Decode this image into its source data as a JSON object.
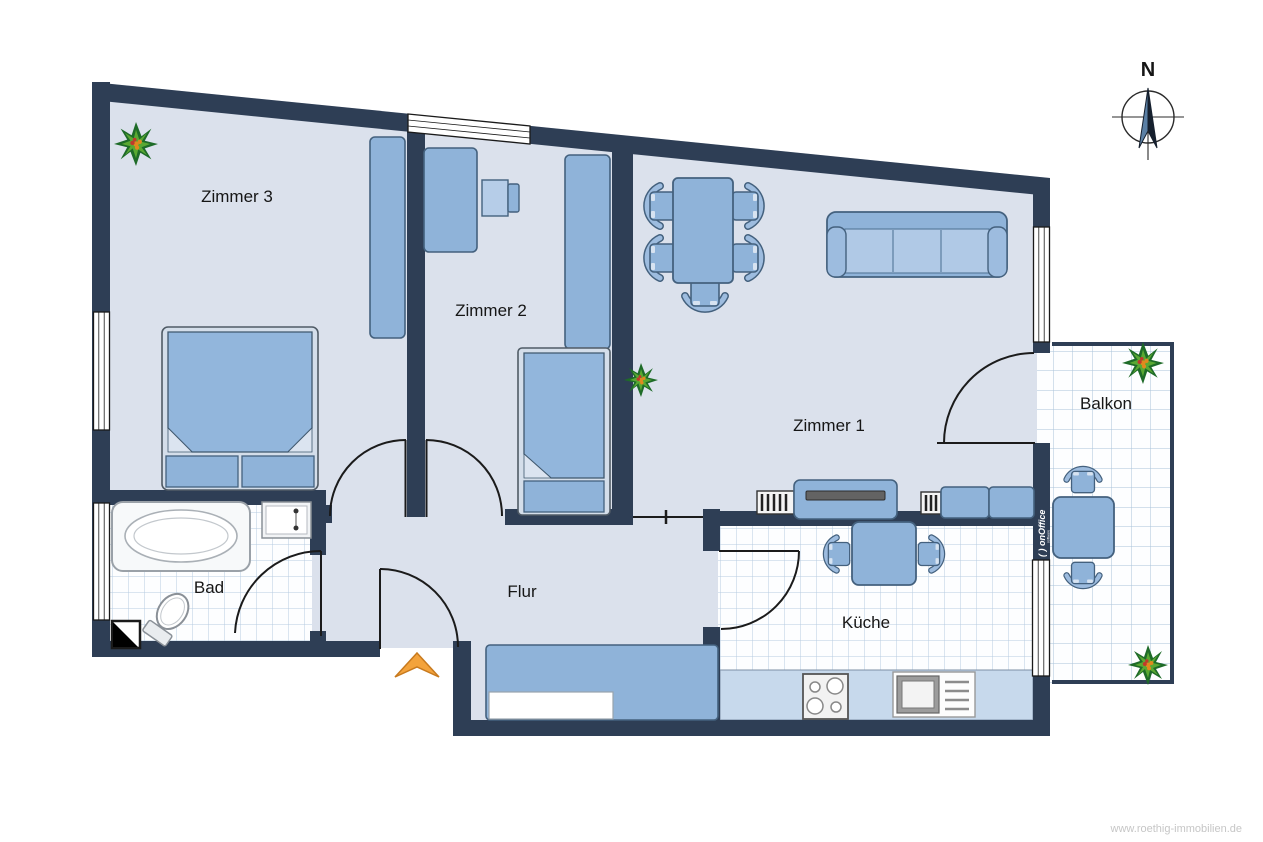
{
  "meta": {
    "watermark": "www.roethig-immobilien.de"
  },
  "compass": {
    "label": "N"
  },
  "branding": {
    "logo_primary": "( ) onOffice",
    "logo_secondary": "software"
  },
  "rooms": {
    "zimmer3": {
      "label": "Zimmer 3"
    },
    "zimmer2": {
      "label": "Zimmer 2"
    },
    "zimmer1": {
      "label": "Zimmer 1"
    },
    "bad": {
      "label": "Bad"
    },
    "flur": {
      "label": "Flur"
    },
    "kueche": {
      "label": "Küche"
    },
    "balkon": {
      "label": "Balkon"
    }
  },
  "colors": {
    "wall": "#2e3e55",
    "floor": "#dbe1ec",
    "furniture": "#8fb3d9",
    "furniture_light": "#b3cbe7",
    "tile_line": "#b7cce0",
    "entrance_arrow": "#f3a33c",
    "plant_green": "#3f9b2f"
  }
}
